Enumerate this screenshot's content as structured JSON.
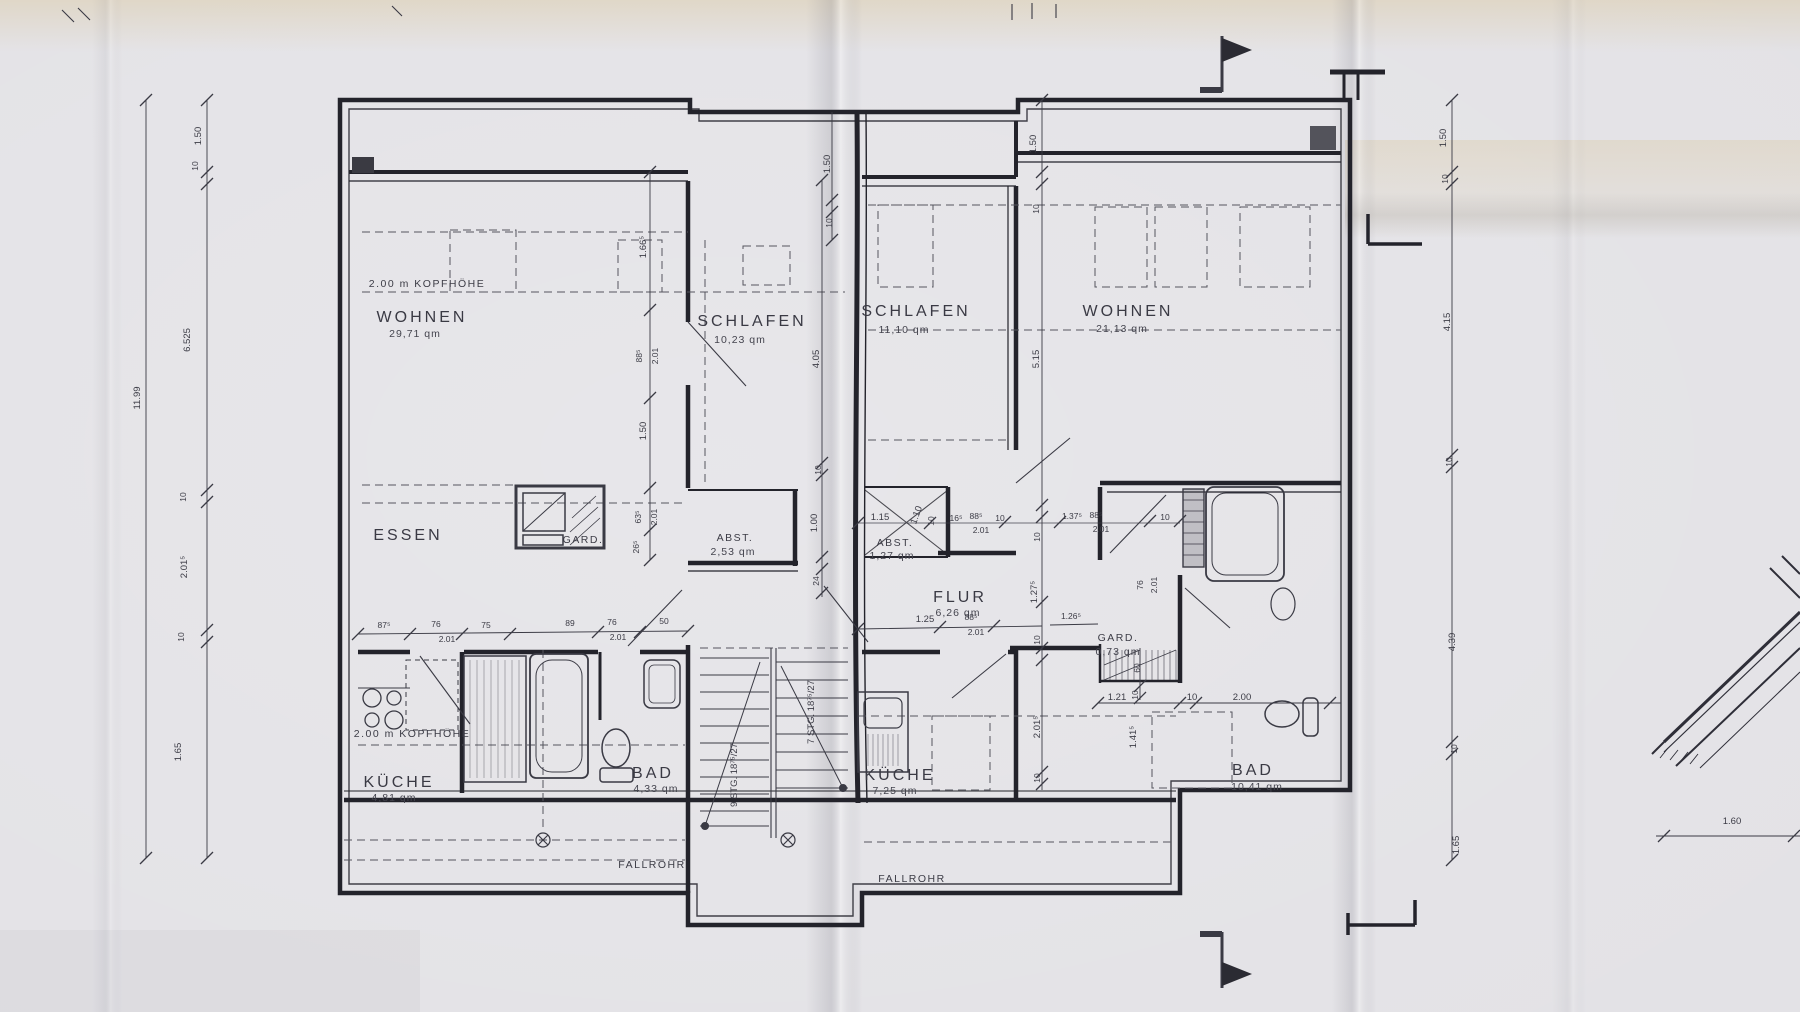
{
  "drawing": {
    "type": "attic floor plan, two apartments",
    "colors": {
      "paper": "#e3e2e6",
      "ink": "#23232b",
      "ink_thin": "#4a4a55",
      "text": "#33333d"
    }
  },
  "rooms": {
    "wohnen_left": {
      "name": "WOHNEN",
      "area": "29,71 qm"
    },
    "schlafen_left": {
      "name": "SCHLAFEN",
      "area": "10,23 qm"
    },
    "schlafen_right": {
      "name": "SCHLAFEN",
      "area": "11,10 qm"
    },
    "wohnen_right": {
      "name": "WOHNEN",
      "area": "21,13 qm"
    },
    "essen": {
      "name": "ESSEN"
    },
    "gard_left": {
      "name": "GARD."
    },
    "abst_left": {
      "name": "ABST.",
      "area": "2,53 qm"
    },
    "abst_right": {
      "name": "ABST.",
      "area": "1,27 qm"
    },
    "flur": {
      "name": "FLUR",
      "area": "6,26 qm"
    },
    "gard_right": {
      "name": "GARD.",
      "area": "0,73 qm"
    },
    "kueche_left": {
      "name": "KÜCHE",
      "area": "4,81 qm"
    },
    "bad_left": {
      "name": "BAD",
      "area": "4,33 qm"
    },
    "kueche_right": {
      "name": "KÜCHE",
      "area": "7,25 qm"
    },
    "bad_right": {
      "name": "BAD",
      "area": "10,41 qm"
    }
  },
  "annotations": {
    "kopfhoehe_top": "2.00 m KOPFHÖHE",
    "kopfhoehe_bottom": "2.00 m KOPFHÖHE",
    "fallrohr_left": "FALLROHR",
    "fallrohr_right": "FALLROHR",
    "stairs_9": "9 STG. 18⁷⁵/27",
    "stairs_7": "7 STG. 18⁷⁵/27"
  },
  "dimensions": {
    "left_outer": "11.99",
    "left_chain": [
      "1.50",
      "10",
      "6.525",
      "10",
      "2.01⁵",
      "10",
      "1.65"
    ],
    "right_chain": [
      "1.50",
      "10",
      "4.15",
      "10",
      "4.39",
      "10",
      "1.65"
    ],
    "unit_left_chain": [
      "1.66⁵",
      "88⁵",
      "2.01",
      "1.50",
      "63⁵",
      "2.01",
      "26⁵"
    ],
    "schlafen_chain": [
      "4.05",
      "10",
      "1.00",
      "24"
    ],
    "right_unit_chain": [
      "1.50",
      "10",
      "5.15",
      "10",
      "1.27⁵",
      "10",
      "2.01⁵",
      "10"
    ],
    "party_top": [
      "1.50",
      "10"
    ],
    "kitchen_row": [
      "87⁵",
      "76",
      "2.01",
      "75",
      "89",
      "76",
      "2.01",
      "50"
    ],
    "mid_row": [
      "1.15",
      "1.10",
      "10",
      "16⁵",
      "88⁵",
      "2.01",
      "10",
      "1.37⁵",
      "88⁵",
      "2.01",
      "10"
    ],
    "flur_row": [
      "1.25",
      "88⁵",
      "2.01",
      "1.26⁵"
    ],
    "gard_group": [
      "60",
      "10",
      "1.21",
      "10",
      "2.00",
      "1.41⁵",
      "76",
      "2.01"
    ],
    "detail": "1.60"
  }
}
